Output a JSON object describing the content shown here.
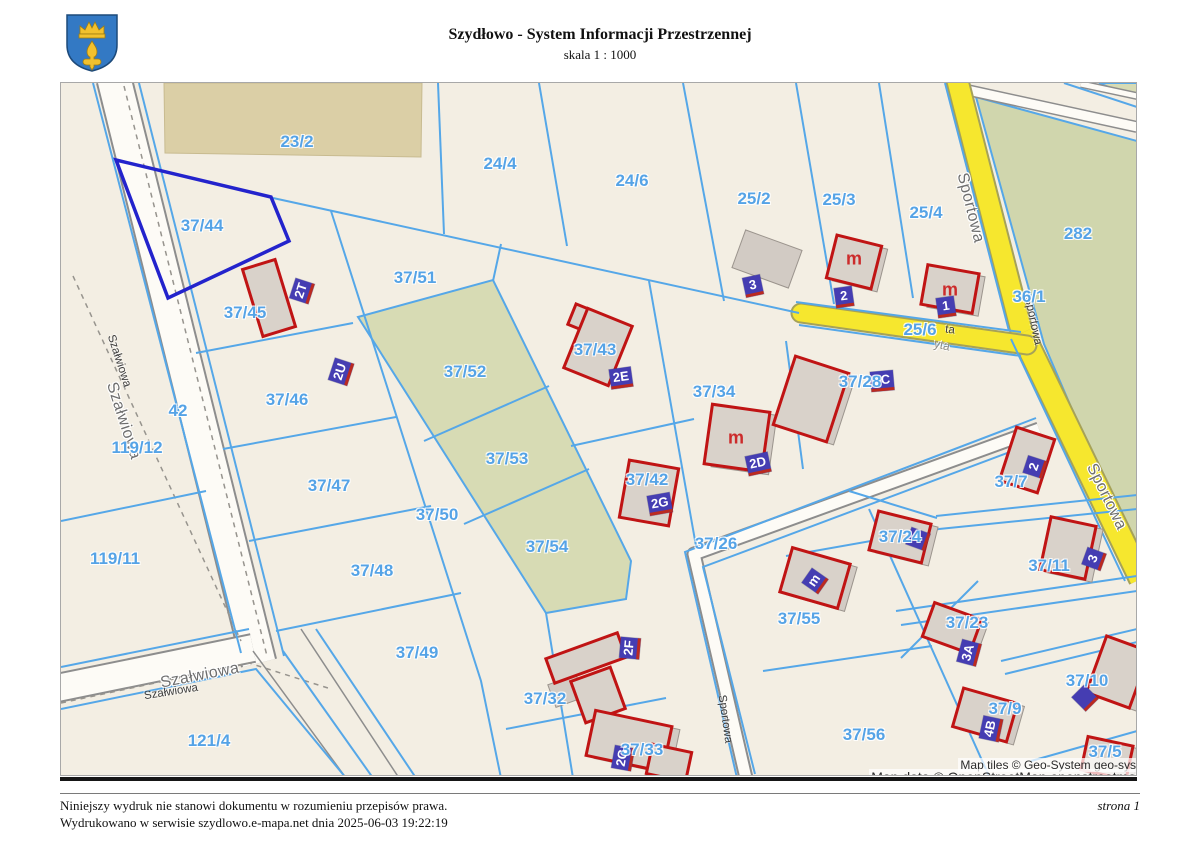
{
  "header": {
    "title": "Szydłowo - System Informacji Przestrzennej",
    "scale": "skala 1 : 1000",
    "crest_icon": "town-coat-of-arms",
    "crest_colors": {
      "shield": "#3379c4",
      "charge": "#f2c12e"
    }
  },
  "footer": {
    "line1": "Niniejszy wydruk nie stanowi dokumentu w rozumieniu przepisów prawa.",
    "line2": "Wydrukowano w serwisie szydlowo.e-mapa.net dnia 2025-06-03 19:22:19",
    "page": "strona 1"
  },
  "map": {
    "attribution": {
      "line1": "Map tiles © Geo-System geo-sys",
      "line2": "Map data © OpenStreetMap openstreetma"
    },
    "colors": {
      "map_bg": "#f3eee3",
      "parcel_line": "#55a7e8",
      "selected_parcel": "#2323cc",
      "parcel_text": "#55a3e6",
      "building_fill": "#d9d2ca",
      "building_stroke": "#c01414",
      "gray_building_fill": "#d2cbc4",
      "label_box_bg": "#453db2",
      "label_box_edge": "#bb2a20",
      "road_yellow": "#f6e72e",
      "road_white": "#fdfbf6",
      "road_casing": "#8d8d8d",
      "green_area": "#d7dbb4",
      "green_282": "#d0d6ad",
      "tan_area": "#dbcfa6",
      "m_letter": "#cc2b2b",
      "street_text": "#6e6e6e"
    },
    "parcel_labels": [
      {
        "text": "23/2",
        "x": 296,
        "y": 141
      },
      {
        "text": "24/4",
        "x": 499,
        "y": 163
      },
      {
        "text": "24/6",
        "x": 631,
        "y": 180
      },
      {
        "text": "25/2",
        "x": 753,
        "y": 198
      },
      {
        "text": "25/3",
        "x": 838,
        "y": 199
      },
      {
        "text": "25/4",
        "x": 925,
        "y": 212
      },
      {
        "text": "282",
        "x": 1077,
        "y": 233
      },
      {
        "text": "36/1",
        "x": 1028,
        "y": 296
      },
      {
        "text": "37/44",
        "x": 201,
        "y": 225
      },
      {
        "text": "37/45",
        "x": 244,
        "y": 312
      },
      {
        "text": "37/51",
        "x": 414,
        "y": 277
      },
      {
        "text": "25/6",
        "x": 919,
        "y": 329
      },
      {
        "text": "37/43",
        "x": 594,
        "y": 349
      },
      {
        "text": "37/52",
        "x": 464,
        "y": 371
      },
      {
        "text": "37/28",
        "x": 859,
        "y": 381
      },
      {
        "text": "37/34",
        "x": 713,
        "y": 391
      },
      {
        "text": "37/46",
        "x": 286,
        "y": 399
      },
      {
        "text": "42",
        "x": 177,
        "y": 410
      },
      {
        "text": "119/12",
        "x": 136,
        "y": 447
      },
      {
        "text": "37/53",
        "x": 506,
        "y": 458
      },
      {
        "text": "37/42",
        "x": 646,
        "y": 479
      },
      {
        "text": "37/7",
        "x": 1010,
        "y": 481
      },
      {
        "text": "37/47",
        "x": 328,
        "y": 485
      },
      {
        "text": "37/50",
        "x": 436,
        "y": 514
      },
      {
        "text": "37/24",
        "x": 899,
        "y": 536
      },
      {
        "text": "37/26",
        "x": 715,
        "y": 543
      },
      {
        "text": "37/54",
        "x": 546,
        "y": 546
      },
      {
        "text": "119/11",
        "x": 114,
        "y": 558
      },
      {
        "text": "37/11",
        "x": 1048,
        "y": 565
      },
      {
        "text": "37/48",
        "x": 371,
        "y": 570
      },
      {
        "text": "37/55",
        "x": 798,
        "y": 618
      },
      {
        "text": "37/23",
        "x": 966,
        "y": 622
      },
      {
        "text": "37/49",
        "x": 416,
        "y": 652
      },
      {
        "text": "37/10",
        "x": 1086,
        "y": 680
      },
      {
        "text": "37/32",
        "x": 544,
        "y": 698
      },
      {
        "text": "37/9",
        "x": 1004,
        "y": 708
      },
      {
        "text": "37/56",
        "x": 863,
        "y": 734
      },
      {
        "text": "121/4",
        "x": 208,
        "y": 740
      },
      {
        "text": "37/33",
        "x": 641,
        "y": 749
      },
      {
        "text": "37/5",
        "x": 1104,
        "y": 751
      }
    ],
    "street_labels": [
      {
        "text": "Szałwiowa",
        "x": 118,
        "y": 360,
        "rot": 72,
        "style": "sl-small"
      },
      {
        "text": "Szałwiowa",
        "x": 122,
        "y": 420,
        "rot": 72,
        "style": "sl-big"
      },
      {
        "text": "Szałwiowa",
        "x": 199,
        "y": 675,
        "rot": -11,
        "style": "sl-big"
      },
      {
        "text": "Szałwiowa",
        "x": 170,
        "y": 691,
        "rot": -9,
        "style": "sl-small"
      },
      {
        "text": "Sportowa",
        "x": 969,
        "y": 207,
        "rot": 76,
        "style": "sl-big"
      },
      {
        "text": "Sportowa",
        "x": 1032,
        "y": 320,
        "rot": 78,
        "style": "sl-small"
      },
      {
        "text": "Sportowa",
        "x": 1105,
        "y": 496,
        "rot": 64,
        "style": "sl-big"
      },
      {
        "text": "Sportowa",
        "x": 724,
        "y": 718,
        "rot": 82,
        "style": "sl-small"
      },
      {
        "text": "ta",
        "x": 949,
        "y": 329,
        "rot": 6,
        "style": "sl-small"
      },
      {
        "text": "yta",
        "x": 941,
        "y": 344,
        "rot": 12,
        "style": "sl-faint"
      }
    ],
    "building_labels": [
      {
        "text": "2T",
        "x": 301,
        "y": 290,
        "rot": -72
      },
      {
        "text": "2U",
        "x": 340,
        "y": 371,
        "rot": -72
      },
      {
        "text": "3",
        "x": 752,
        "y": 285,
        "rot": -12
      },
      {
        "text": "2",
        "x": 843,
        "y": 296,
        "rot": -8
      },
      {
        "text": "1",
        "x": 945,
        "y": 306,
        "rot": -8
      },
      {
        "text": "2E",
        "x": 620,
        "y": 377,
        "rot": -8
      },
      {
        "text": "2C",
        "x": 881,
        "y": 380,
        "rot": -5
      },
      {
        "text": "2D",
        "x": 757,
        "y": 463,
        "rot": -12
      },
      {
        "text": "2G",
        "x": 659,
        "y": 503,
        "rot": -10
      },
      {
        "text": "2",
        "x": 1034,
        "y": 466,
        "rot": -72
      },
      {
        "text": "3",
        "x": 1093,
        "y": 558,
        "rot": -70
      },
      {
        "text": "3A",
        "x": 968,
        "y": 652,
        "rot": -75
      },
      {
        "text": "4B",
        "x": 990,
        "y": 728,
        "rot": -78
      },
      {
        "text": "m",
        "x": 814,
        "y": 580,
        "rot": -55
      },
      {
        "text": "2F",
        "x": 629,
        "y": 647,
        "rot": -85
      },
      {
        "text": "2G",
        "x": 622,
        "y": 757,
        "rot": -80
      },
      {
        "text": "",
        "x": 917,
        "y": 538,
        "rot": -70
      },
      {
        "text": "",
        "x": 1084,
        "y": 697,
        "rot": -45
      }
    ],
    "house_letters": [
      {
        "text": "m",
        "x": 853,
        "y": 258
      },
      {
        "text": "m",
        "x": 949,
        "y": 289
      },
      {
        "text": "m",
        "x": 735,
        "y": 437
      }
    ]
  }
}
